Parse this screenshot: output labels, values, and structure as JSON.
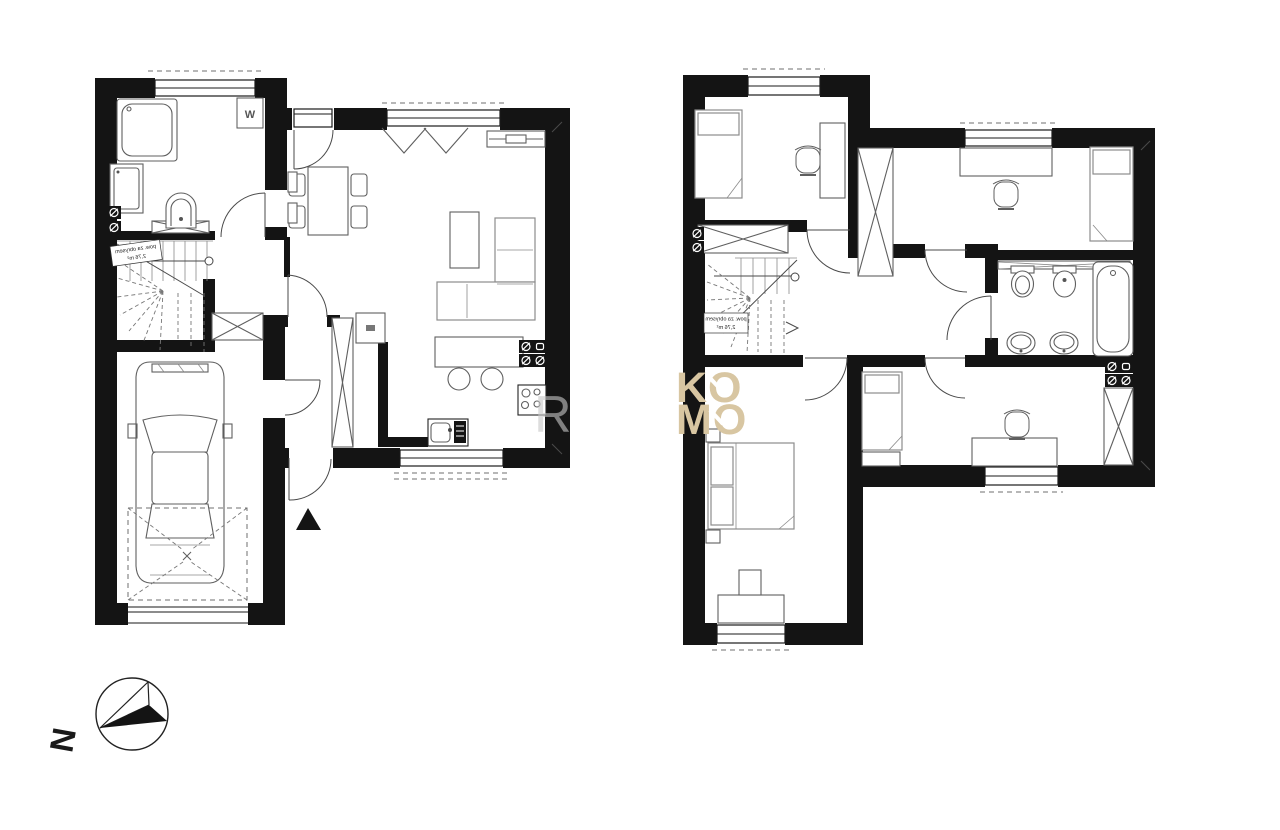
{
  "canvas": {
    "width": 1280,
    "height": 830,
    "background": "#ffffff"
  },
  "watermark": {
    "line1": "KO",
    "line2": "MO",
    "color": "#d8c6a2",
    "partial_letter": "R",
    "partial_letter_color": "#c8c8c8"
  },
  "compass": {
    "letter": "N"
  },
  "ground_floor": {
    "boiler_label": "W",
    "stairs_note_line1": "pow. za obrysem",
    "stairs_note_line2": "2,76 m²"
  },
  "upper_floor": {
    "stairs_note_line1": "pow. za obrysem",
    "stairs_note_line2": "2,76 m²"
  },
  "colors": {
    "wall": "#141414",
    "line": "#3f3f3f",
    "furniture": "#6f6f6f"
  }
}
